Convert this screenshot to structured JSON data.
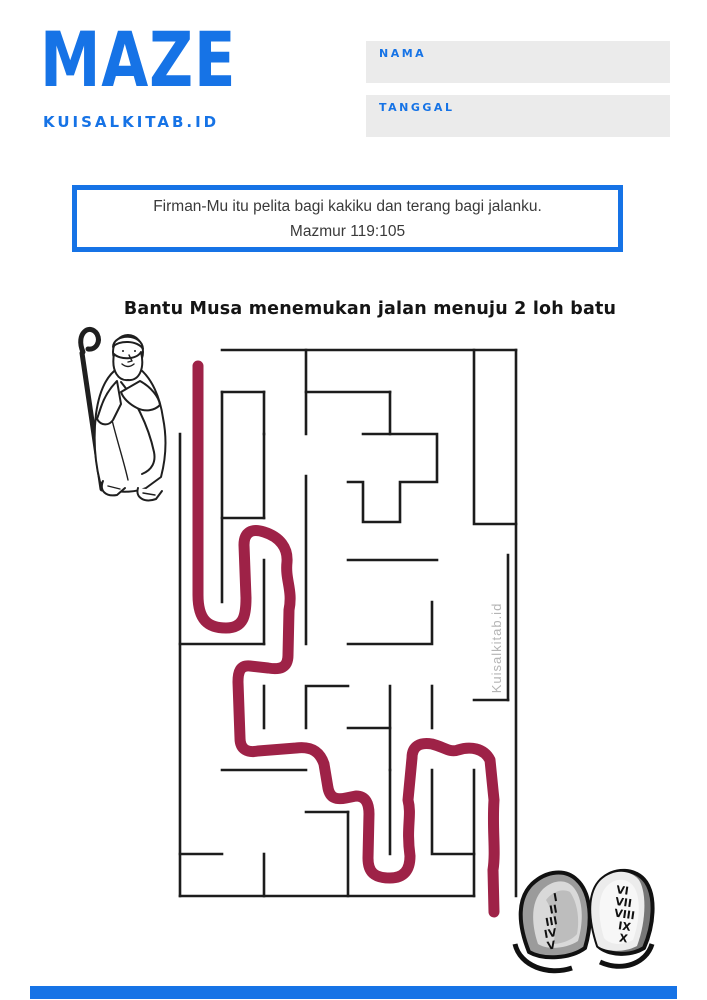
{
  "header": {
    "title": "MAZE",
    "site": "KUISALKITAB.ID",
    "nama_label": "NAMA",
    "nama_value": "",
    "tanggal_label": "TANGGAL",
    "tanggal_value": ""
  },
  "verse": {
    "line1": "Firman-Mu itu pelita bagi kakiku dan terang bagi jalanku.",
    "line2": "Mazmur 119:105"
  },
  "instruction": "Bantu Musa menemukan jalan menuju 2 loh batu",
  "maze": {
    "watermark": "Kuisalkitab.id",
    "wall_color": "#1c1c1c",
    "path_color": "#9e2247",
    "walls": [
      "M222,350 L516,350",
      "M516,350 L516,896",
      "M474,896 L180,896",
      "M180,896 L180,434",
      "M222,392 L222,602",
      "M222,392 L264,392",
      "M264,392 L264,434",
      "M306,350 L306,434",
      "M306,392 L390,392",
      "M390,392 L390,434",
      "M363,434 L437,434 L437,482 L400,482 L400,522 L363,522 L363,482 L348,482",
      "M264,434 L264,518",
      "M222,518 L264,518",
      "M306,476 L306,644",
      "M348,560 L437,560",
      "M264,560 L264,644",
      "M180,644 L264,644",
      "M264,686 L264,728",
      "M348,686 L306,686 L306,728",
      "M222,770 L306,770",
      "M348,644 L432,644 L432,602",
      "M390,686 L390,770",
      "M432,686 L432,728",
      "M348,728 L390,728",
      "M390,770 L390,854",
      "M348,812 L348,896",
      "M306,812 L348,812",
      "M432,770 L432,854 L474,854",
      "M474,770 L474,896",
      "M180,854 L222,854",
      "M264,854 L264,896",
      "M474,350 L474,524 L516,524",
      "M508,555 L508,700",
      "M474,700 L508,700"
    ],
    "solution_path": "M198,366 L198,595 C198,620 208,628 226,628 C244,628 246,615 246,598 L244,545 C244,532 252,528 264,532 C280,537 288,548 287,562 C285,580 293,590 289,610 L288,655 C288,668 280,670 268,668 L250,666 C240,665 238,672 238,682 L240,738 C240,750 248,753 258,751 L296,748 C312,746 320,752 324,764 L328,788 C330,798 336,800 346,798 L356,796 C366,796 369,804 369,814 L368,858 C368,872 374,878 390,878 C404,878 410,870 410,856 C406,826 412,816 408,800 L412,758 C412,746 420,742 432,744 C444,747 450,753 458,750 C470,746 484,748 490,760 L494,800 C492,830 496,850 493,870 L494,912"
  },
  "tablets": {
    "left_numerals": [
      "I",
      "II",
      "III",
      "IV",
      "V"
    ],
    "right_numerals": [
      "VI",
      "VII",
      "VIII",
      "IX",
      "X"
    ]
  },
  "colors": {
    "accent_blue": "#1673e6",
    "field_gray": "#ebebeb",
    "watermark_gray": "#b5b5b5",
    "path_red": "#9e2247"
  }
}
